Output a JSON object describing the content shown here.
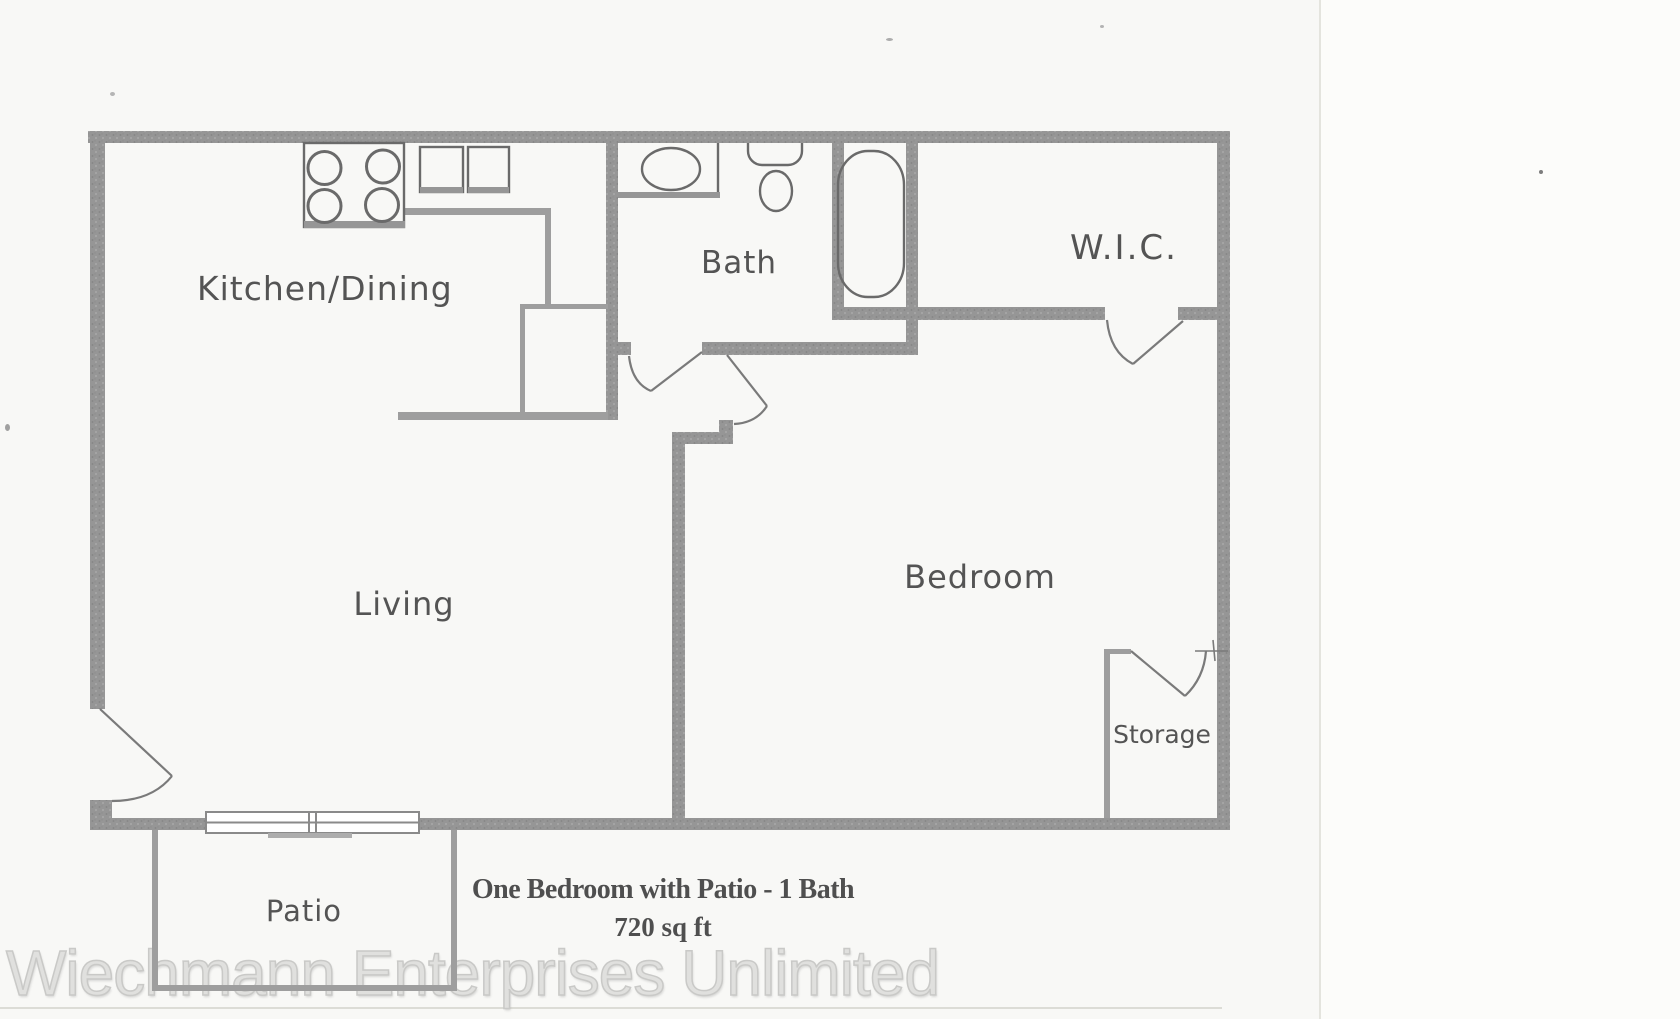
{
  "plan": {
    "title": "One Bedroom with Patio - 1 Bath",
    "area": "720 sq ft",
    "rooms": {
      "kitchen_dining": "Kitchen/Dining",
      "bath": "Bath",
      "wic": "W.I.C.",
      "living": "Living",
      "bedroom": "Bedroom",
      "storage": "Storage",
      "patio": "Patio"
    },
    "fixtures": {
      "stove": "stove-4-burners",
      "kitchen_sink": "double-kitchen-sink",
      "bathroom_sink": "bathroom-vanity-sink",
      "toilet": "toilet",
      "bathtub": "bathtub",
      "patio_door": "sliding-glass-door"
    },
    "colors": {
      "wall": "#969696",
      "thin_wall": "#9e9e9e",
      "fixture_line": "#6a6a6a",
      "door_line": "#7a7a7a",
      "label_text": "#545454",
      "title_text": "#4f4f4f",
      "watermark_text": "#e0e0de",
      "paper": "#f8f8f6"
    }
  },
  "watermark": {
    "text": "Wiechmann Enterprises Unlimited"
  }
}
